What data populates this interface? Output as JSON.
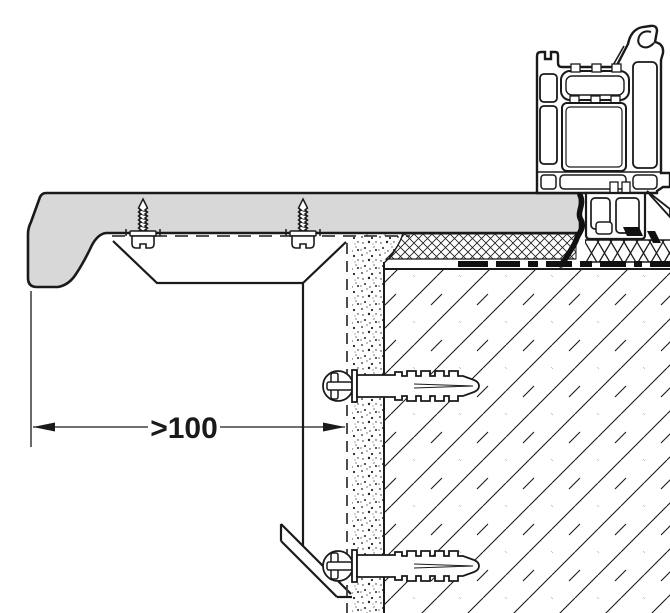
{
  "drawing": {
    "dimension_label": ">100",
    "colors": {
      "line": "#1a1a1a",
      "sill_fill": "#d8d8d8",
      "seal": "#111111",
      "background": "#ffffff"
    }
  }
}
